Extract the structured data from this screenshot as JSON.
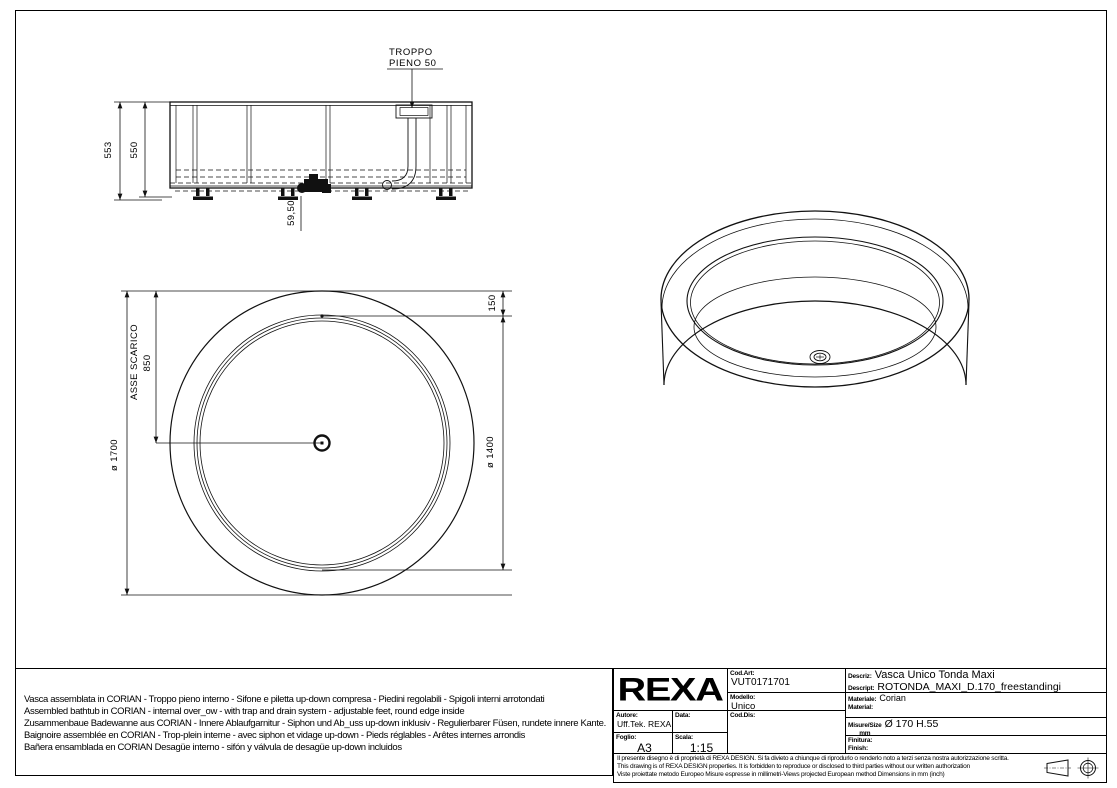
{
  "side_view": {
    "callout_line1": "TROPPO",
    "callout_line2": "PIENO 50",
    "dim_outer_height": "553",
    "dim_inner_height": "550",
    "dim_drain_offset": "59,50"
  },
  "plan_view": {
    "dim_outer_diameter": "ø 1700",
    "dim_inner_diameter": "ø 1400",
    "dim_rim_width": "150",
    "dim_drain_axis": "850",
    "label_drain_axis": "ASSE SCARICO"
  },
  "notes": {
    "lines": [
      "Vasca assemblata in CORIAN - Troppo pieno interno - Sifone e piletta up-down compresa - Piedini regolabili - Spigoli interni arrotondati",
      "Assembled bathtub in CORIAN - internal over_ow - with trap and drain system - adjustable feet, round edge inside",
      "Zusammenbaue Badewanne aus CORIAN - Innere Ablaufgarnitur - Siphon und Ab_uss up-down inklusiv - Regulierbarer Füsen, rundete innere Kante.",
      "Baignoire assemblée en CORIAN - Trop-plein interne - avec siphon et vidage up-down - Pieds réglables - Arêtes internes arrondis",
      "Bañera ensamblada en CORIAN Desagüe interno - sifón y válvula de desagüe up-down incluidos"
    ]
  },
  "title_block": {
    "logo": "REXA",
    "cod_art_label": "Cod.Art:",
    "cod_art_value": "VUT0171701",
    "modello_label": "Modello:",
    "modello_value": "Unico",
    "cod_dis_label": "Cod.Dis:",
    "autore_label": "Autore:",
    "autore_value": "Uff.Tek. REXA",
    "data_label": "Data:",
    "foglio_label": "Foglio:",
    "foglio_value": "A3",
    "scala_label": "Scala:",
    "scala_value": "1:15",
    "descriz_label": "Descriz:",
    "descriz_value": "Vasca Unico Tonda Maxi",
    "descript_label": "Descript:",
    "descript_value": "ROTONDA_MAXI_D.170_freestandingi",
    "materiale_label": "Materiale:",
    "materiale_value": "Corian",
    "material_label": "Material:",
    "misure_label": "Misure/Size",
    "misure_unit": "mm",
    "misure_value": "Ø 170 H.55",
    "finitura_label": "Finitura:",
    "finish_label": "Finish:",
    "disclaimer_line1": "Il presente disegno è di proprietà di REXA DESIGN. Si fa divieto a chiunque di riprodurlo o renderlo noto a terzi senza nostra autorizzazione scritta.",
    "disclaimer_line2": "This drawing is of REXA DESIGN properties. It is forbidden to reproduce or disclosed to third parties without our written authorization",
    "disclaimer_line3": "Viste proiettate metodo Europeo Misure espresse in millimetri-Views projected European method Dimensions in mm (inch)"
  }
}
